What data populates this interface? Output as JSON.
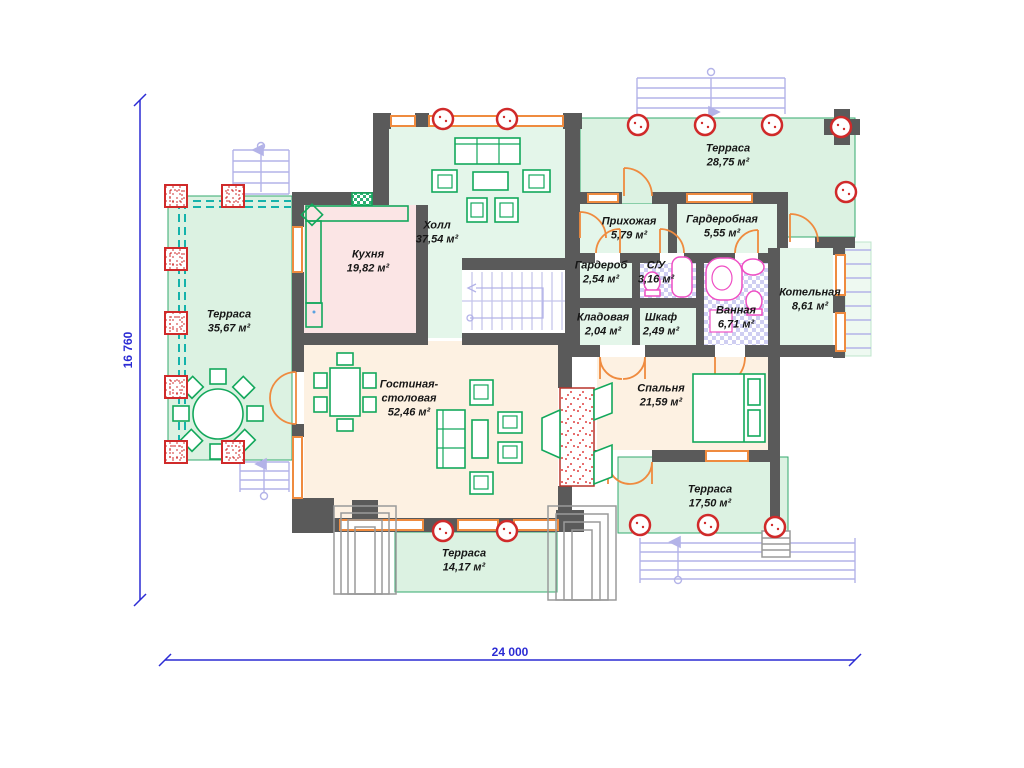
{
  "plan": {
    "title": "План 1 этажа",
    "dimensions": {
      "width": "24 000",
      "height": "16 760"
    },
    "rooms": {
      "terrace_left": {
        "name": "Терраса",
        "area": "35,67 м²"
      },
      "kitchen": {
        "name": "Кухня",
        "area": "19,82 м²"
      },
      "hall": {
        "name": "Холл",
        "area": "37,54 м²"
      },
      "terrace_top": {
        "name": "Терраса",
        "area": "28,75 м²"
      },
      "entry": {
        "name": "Прихожая",
        "area": "5,79 м²"
      },
      "wardrobe_room": {
        "name": "Гардеробная",
        "area": "5,55 м²"
      },
      "wardrobe": {
        "name": "Гардероб",
        "area": "2,54 м²"
      },
      "wc": {
        "name": "С/У",
        "area": "3,16 м²"
      },
      "boiler": {
        "name": "Котельная",
        "area": "8,61 м²"
      },
      "storage": {
        "name": "Кладовая",
        "area": "2,04 м²"
      },
      "closet": {
        "name": "Шкаф",
        "area": "2,49 м²"
      },
      "bath": {
        "name": "Ванная",
        "area": "6,71 м²"
      },
      "living": {
        "name": "Гостиная-столовая",
        "area": "52,46 м²"
      },
      "bedroom": {
        "name": "Спальня",
        "area": "21,59 м²"
      },
      "terrace_se": {
        "name": "Терраса",
        "area": "17,50 м²"
      },
      "terrace_south": {
        "name": "Терраса",
        "area": "14,17 м²"
      }
    },
    "colors": {
      "wall": "#5a5a5a",
      "terrace_green": "#def2e4",
      "room_cream": "#fdf1e2",
      "kitchen_pink": "#fbe5e5",
      "window_orange": "#ef8b3f",
      "furniture_green": "#13a85c",
      "column_red": "#d02a2a",
      "dimension_blue": "#2b2bd4",
      "stairs_lavender": "#bcbcec",
      "fixture_pink": "#ef4fc4"
    }
  }
}
